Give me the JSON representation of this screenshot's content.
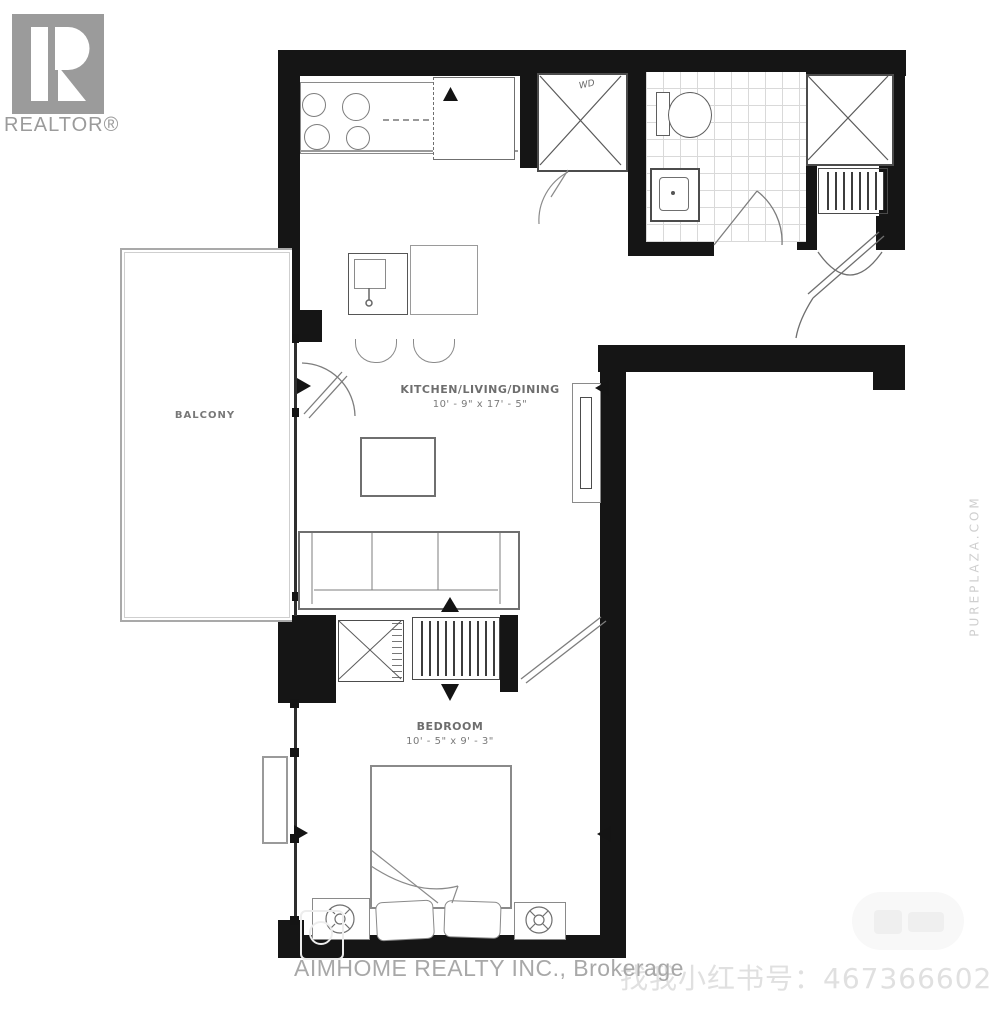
{
  "logo": {
    "label": "REALTOR®"
  },
  "rooms": {
    "balcony": {
      "label": "BALCONY"
    },
    "kitchen_living_dining": {
      "label": "KITCHEN/LIVING/DINING",
      "dimensions": "10' - 9\" x 17' - 5\""
    },
    "bedroom": {
      "label": "BEDROOM",
      "dimensions": "10' - 5\" x 9' - 3\""
    },
    "laundry_closet": {
      "label": "WD"
    }
  },
  "footer": {
    "brokerage": "AIMHOME REALTY INC., Brokerage"
  },
  "watermarks": {
    "social": "找我小红书号：467366602",
    "side": "PUREPLAZA.COM"
  },
  "colors": {
    "wall": "#151515",
    "furniture_line": "#8a8a8a",
    "logo_gray": "#9b9b9b",
    "footer_gray": "#a8a8a8",
    "watermark_gray": "#e0e0e0",
    "background": "#ffffff"
  }
}
